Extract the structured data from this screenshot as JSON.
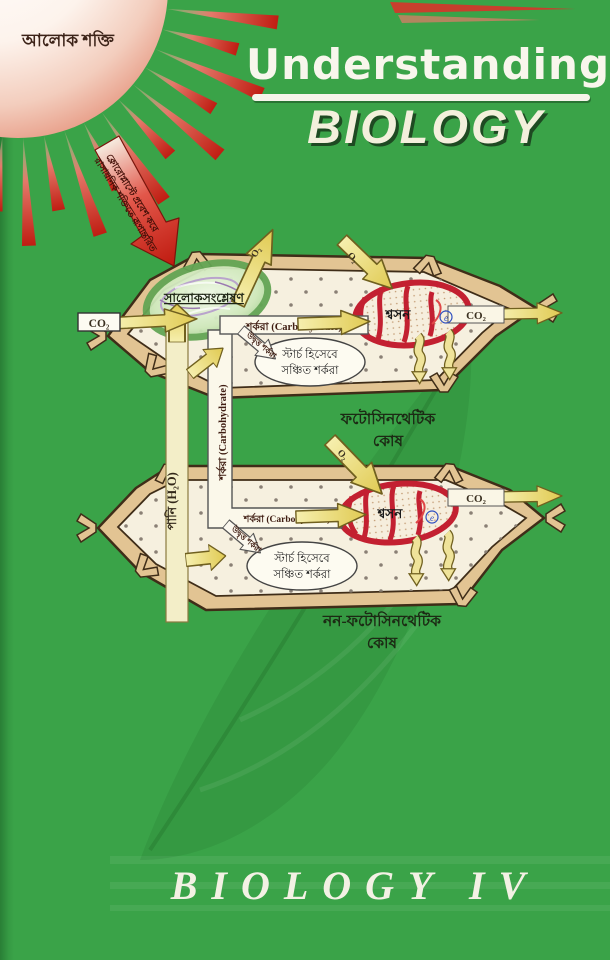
{
  "header": {
    "title_line1": "Understanding",
    "title_line2": "BIOLOGY"
  },
  "footer": {
    "series_title": "BIOLOGY IV"
  },
  "sun": {
    "label": "আলোক শক্তি"
  },
  "energy_arrow": {
    "line1": "ক্লোরোপ্লাস্টে প্রবেশ করে",
    "line2": "রাসায়নিক শক্তিতে রূপান্তরিত"
  },
  "labels": {
    "co2": "CO₂",
    "o2": "O₂",
    "carbohydrate": "শর্করা (Carbohydrate)",
    "surplus_sugar": "উদ্বৃত্ত শর্করা",
    "starch_line1": "স্টার্চ হিসেবে",
    "starch_line2": "সঞ্চিত শর্করা",
    "water": "পানি (H₂O)",
    "photosynthesis": "সালোকসংশ্লেষণ",
    "respiration": "শ্বসন",
    "electron": "e",
    "cell1_caption_line1": "ফটোসিনথেটিক",
    "cell1_caption_line2": "কোষ",
    "cell2_caption_line1": "নন-ফটোসিনথেটিক",
    "cell2_caption_line2": "কোষ"
  },
  "colors": {
    "cover_green": "#3aa348",
    "sun_red": "#d3281c",
    "arrow_yellow": "#e9d668",
    "mitochondrion_red": "#c32031",
    "chloroplast_green": "#8fc97d",
    "cell_wall_tan": "#e2c493"
  }
}
